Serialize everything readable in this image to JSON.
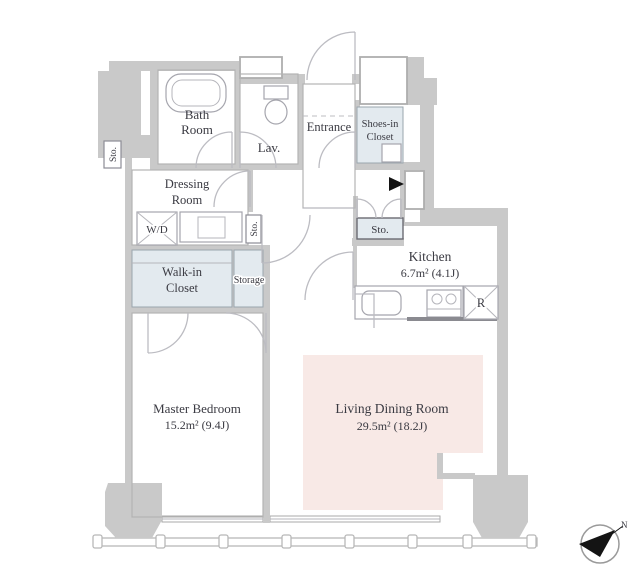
{
  "floorplan": {
    "rooms": {
      "bath": {
        "line1": "Bath",
        "line2": "Room"
      },
      "lav": {
        "label": "Lav."
      },
      "entrance": {
        "label": "Entrance"
      },
      "shoes_closet": {
        "line1": "Shoes-in",
        "line2": "Closet"
      },
      "dressing": {
        "line1": "Dressing",
        "line2": "Room"
      },
      "washer_dryer": {
        "label": "W/D"
      },
      "walk_in_closet": {
        "line1": "Walk-in",
        "line2": "Closet"
      },
      "storage": {
        "label": "Storage"
      },
      "sto_left": {
        "label": "Sto."
      },
      "sto_mid": {
        "label": "Sto."
      },
      "sto_hall": {
        "label": "Sto."
      },
      "kitchen": {
        "label": "Kitchen",
        "area": "6.7m²  (4.1J)"
      },
      "master_bedroom": {
        "label": "Master Bedroom",
        "area": "15.2m²  (9.4J)"
      },
      "living_dining": {
        "label": "Living Dining Room",
        "area": "29.5m²  (18.2J)"
      },
      "refrigerator": {
        "label": "R"
      }
    },
    "compass": {
      "north_label": "N"
    },
    "colors": {
      "wall": "#c9c9c9",
      "closet_fill": "#e3eaef",
      "living_fill": "#f8e9e6",
      "ink": "#141414"
    }
  }
}
